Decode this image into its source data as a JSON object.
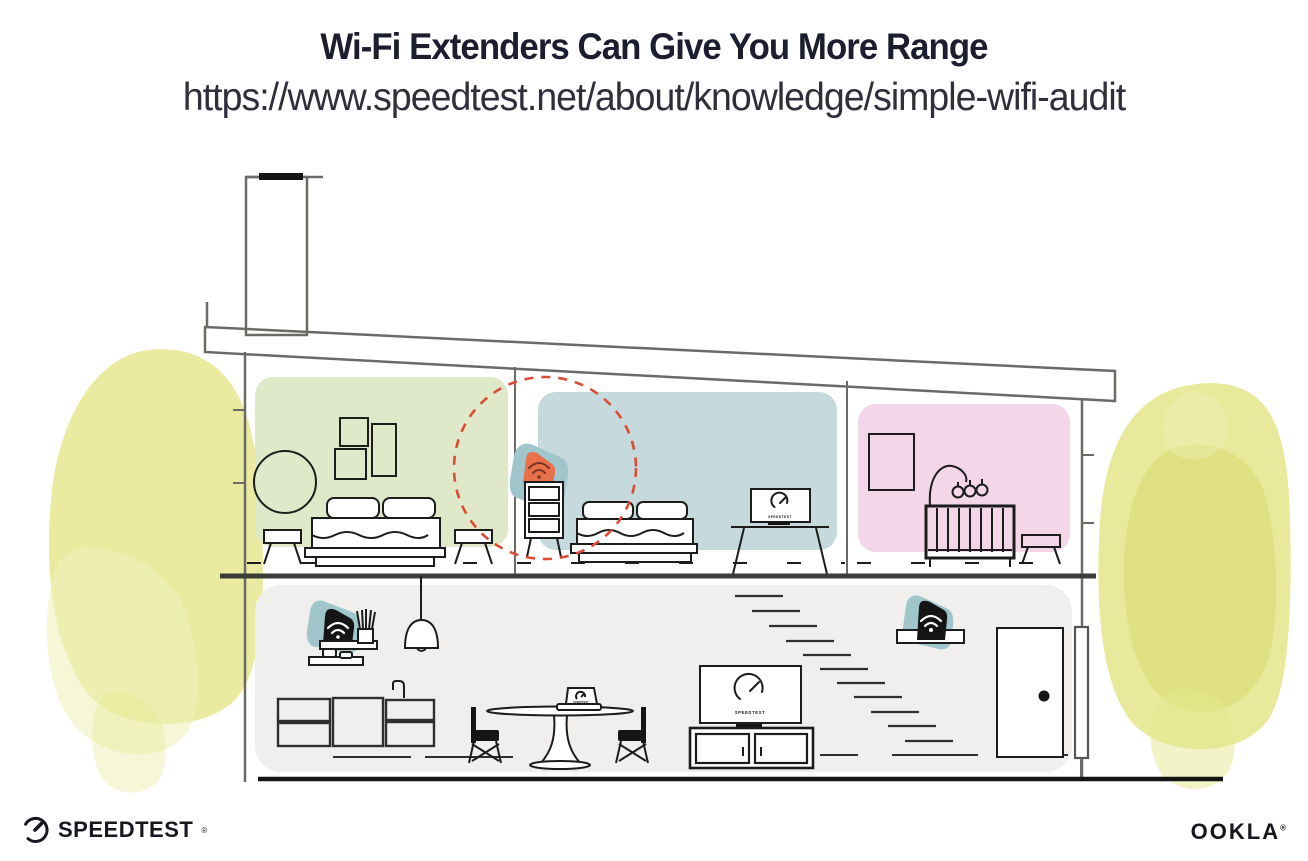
{
  "header": {
    "title": "Wi-Fi Extenders Can Give You More Range",
    "url": "https://www.speedtest.net/about/knowledge/simple-wifi-audit"
  },
  "illustration": {
    "tv_label": "SPEEDTEST",
    "bedroom_tv_label": "SPEEDTEST",
    "laptop_label": "SPEEDTEST",
    "colors": {
      "room_green": "#dfe9ca",
      "room_blue": "#c6dadd",
      "room_pink": "#f3d7e8",
      "floor_gray": "#f0efed",
      "extender_orange": "#e8714b",
      "extender_teal": "#a0c6cb",
      "device_black": "#151515",
      "coverage_red": "#dc4b33",
      "watercolor_yellow": "#e6e78f",
      "watercolor_yellow_dark": "#d9da72",
      "watercolor_yellow_light": "#eff1bb"
    }
  },
  "footer": {
    "speedtest_text": "SPEEDTEST",
    "speedtest_reg": "®",
    "ookla_text": "OOKLA",
    "ookla_reg": "®"
  }
}
